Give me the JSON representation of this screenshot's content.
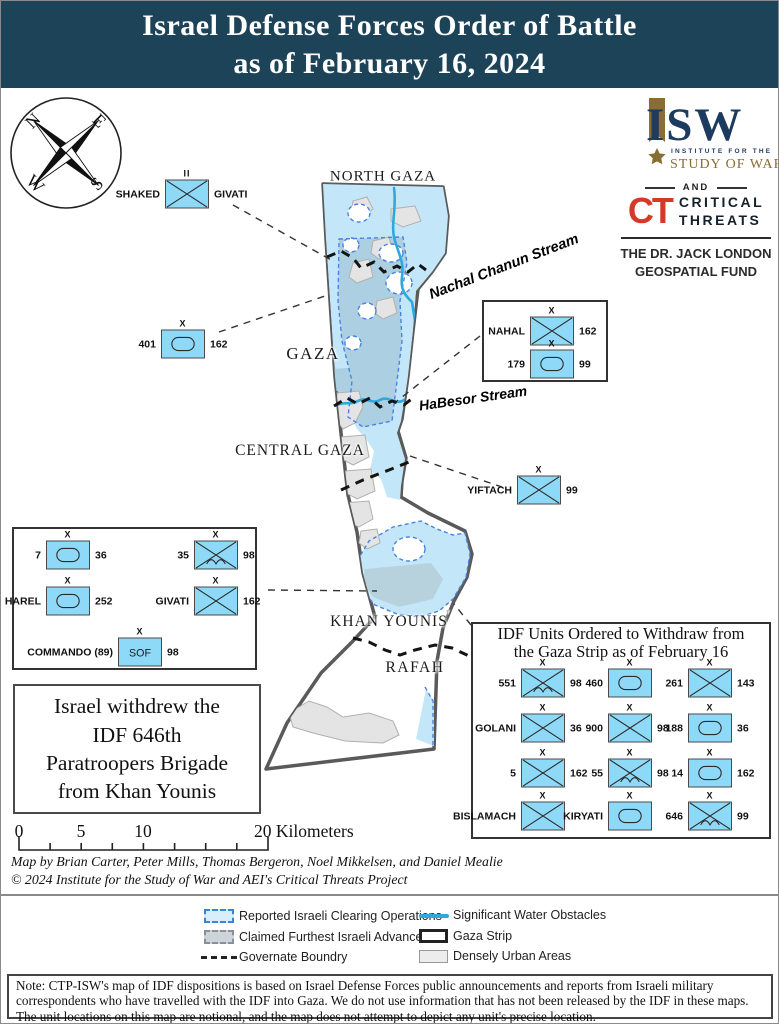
{
  "title": {
    "line1": "Israel Defense Forces Order of Battle",
    "line2": "as of February 16, 2024"
  },
  "branding": {
    "isw_acronym": "ISW",
    "isw_sub1": "INSTITUTE FOR THE",
    "isw_sub2": "STUDY OF WAR",
    "and_label": "AND",
    "ct_acronym": "CT",
    "ct_word1": "CRITICAL",
    "ct_word2": "THREATS",
    "fund": "THE DR. JACK LONDON\nGEOSPATIAL FUND"
  },
  "compass": {
    "north": "N",
    "east": "E",
    "south": "S",
    "west": "W"
  },
  "map_labels": {
    "north_gaza": "NORTH GAZA",
    "gaza": "GAZA",
    "central_gaza": "CENTRAL GAZA",
    "khan_younis": "KHAN YOUNIS",
    "rafah": "RAFAH",
    "stream1": "Nachal Chanun Stream",
    "stream2": "HaBesor Stream"
  },
  "map_units": [
    {
      "left": "SHAKED",
      "right": "GIVATI",
      "echelon": "II",
      "type": "infantry"
    },
    {
      "left": "401",
      "right": "162",
      "echelon": "X",
      "type": "armor"
    },
    {
      "left": "YIFTACH",
      "right": "99",
      "echelon": "X",
      "type": "infantry"
    }
  ],
  "nahal_box": {
    "units": [
      {
        "left": "NAHAL",
        "right": "162",
        "echelon": "X",
        "type": "infantry"
      },
      {
        "left": "179",
        "right": "99",
        "echelon": "X",
        "type": "armor"
      }
    ]
  },
  "left_box": {
    "units": [
      {
        "left": "7",
        "right": "36",
        "echelon": "X",
        "type": "armor"
      },
      {
        "left": "35",
        "right": "98",
        "echelon": "X",
        "type": "airborne"
      },
      {
        "left": "HAREL",
        "right": "252",
        "echelon": "X",
        "type": "armor"
      },
      {
        "left": "GIVATI",
        "right": "162",
        "echelon": "X",
        "type": "infantry"
      },
      {
        "left": "COMMANDO (89)",
        "right": "98",
        "echelon": "X",
        "type": "sof",
        "symbol_text": "SOF"
      }
    ]
  },
  "annotation": {
    "text": "Israel withdrew the\nIDF 646th\nParatroopers Brigade\nfrom Khan Younis"
  },
  "withdraw_box": {
    "title": "IDF Units Ordered to Withdraw from\nthe Gaza Strip as of February 16",
    "units": [
      {
        "left": "551",
        "right": "98",
        "echelon": "X",
        "type": "airborne"
      },
      {
        "left": "460",
        "right": "",
        "echelon": "X",
        "type": "armor"
      },
      {
        "left": "261",
        "right": "143",
        "echelon": "X",
        "type": "infantry"
      },
      {
        "left": "GOLANI",
        "right": "36",
        "echelon": "X",
        "type": "infantry"
      },
      {
        "left": "900",
        "right": "98",
        "echelon": "X",
        "type": "infantry"
      },
      {
        "left": "188",
        "right": "36",
        "echelon": "X",
        "type": "armor"
      },
      {
        "left": "5",
        "right": "162",
        "echelon": "X",
        "type": "infantry"
      },
      {
        "left": "55",
        "right": "98",
        "echelon": "X",
        "type": "airborne"
      },
      {
        "left": "14",
        "right": "162",
        "echelon": "X",
        "type": "armor"
      },
      {
        "left": "BISLAMACH",
        "right": "",
        "echelon": "X",
        "type": "infantry"
      },
      {
        "left": "KIRYATI",
        "right": "",
        "echelon": "X",
        "type": "armor"
      },
      {
        "left": "646",
        "right": "99",
        "echelon": "X",
        "type": "airborne"
      }
    ]
  },
  "scale": {
    "t0": "0",
    "t5": "5",
    "t10": "10",
    "t20": "20 Kilometers"
  },
  "credits": {
    "line1": "Map by Brian Carter, Peter Mills, Thomas Bergeron, Noel Mikkelsen, and Daniel Mealie",
    "line2": "© 2024 Institute for the Study of War and AEI's Critical Threats Project"
  },
  "legend": {
    "clearing": "Reported Israeli Clearing Operations",
    "advances": "Claimed Furthest Israeli Advances",
    "governate": "Governate Boundry",
    "water": "Significant Water Obstacles",
    "strip": "Gaza Strip",
    "urban": "Densely Urban Areas"
  },
  "note": "Note: CTP-ISW's map of IDF dispositions is based on Israel Defense Forces public announcements and reports from Israeli military correspondents who have travelled with the IDF into Gaza. We do not use information that has not been released by the IDF in these maps. The unit locations on this map are notional, and the map does not attempt to depict any unit's precise location.",
  "colors": {
    "navy": "#1c4357",
    "unit_fill": "#8ed9f7",
    "clearing": "#c3e7f8",
    "advances": "#accfe2",
    "urban": "#e4e4e4",
    "water": "#2fa8dc",
    "ct_red": "#d43a2a",
    "isw_gold": "#8a6d33"
  }
}
